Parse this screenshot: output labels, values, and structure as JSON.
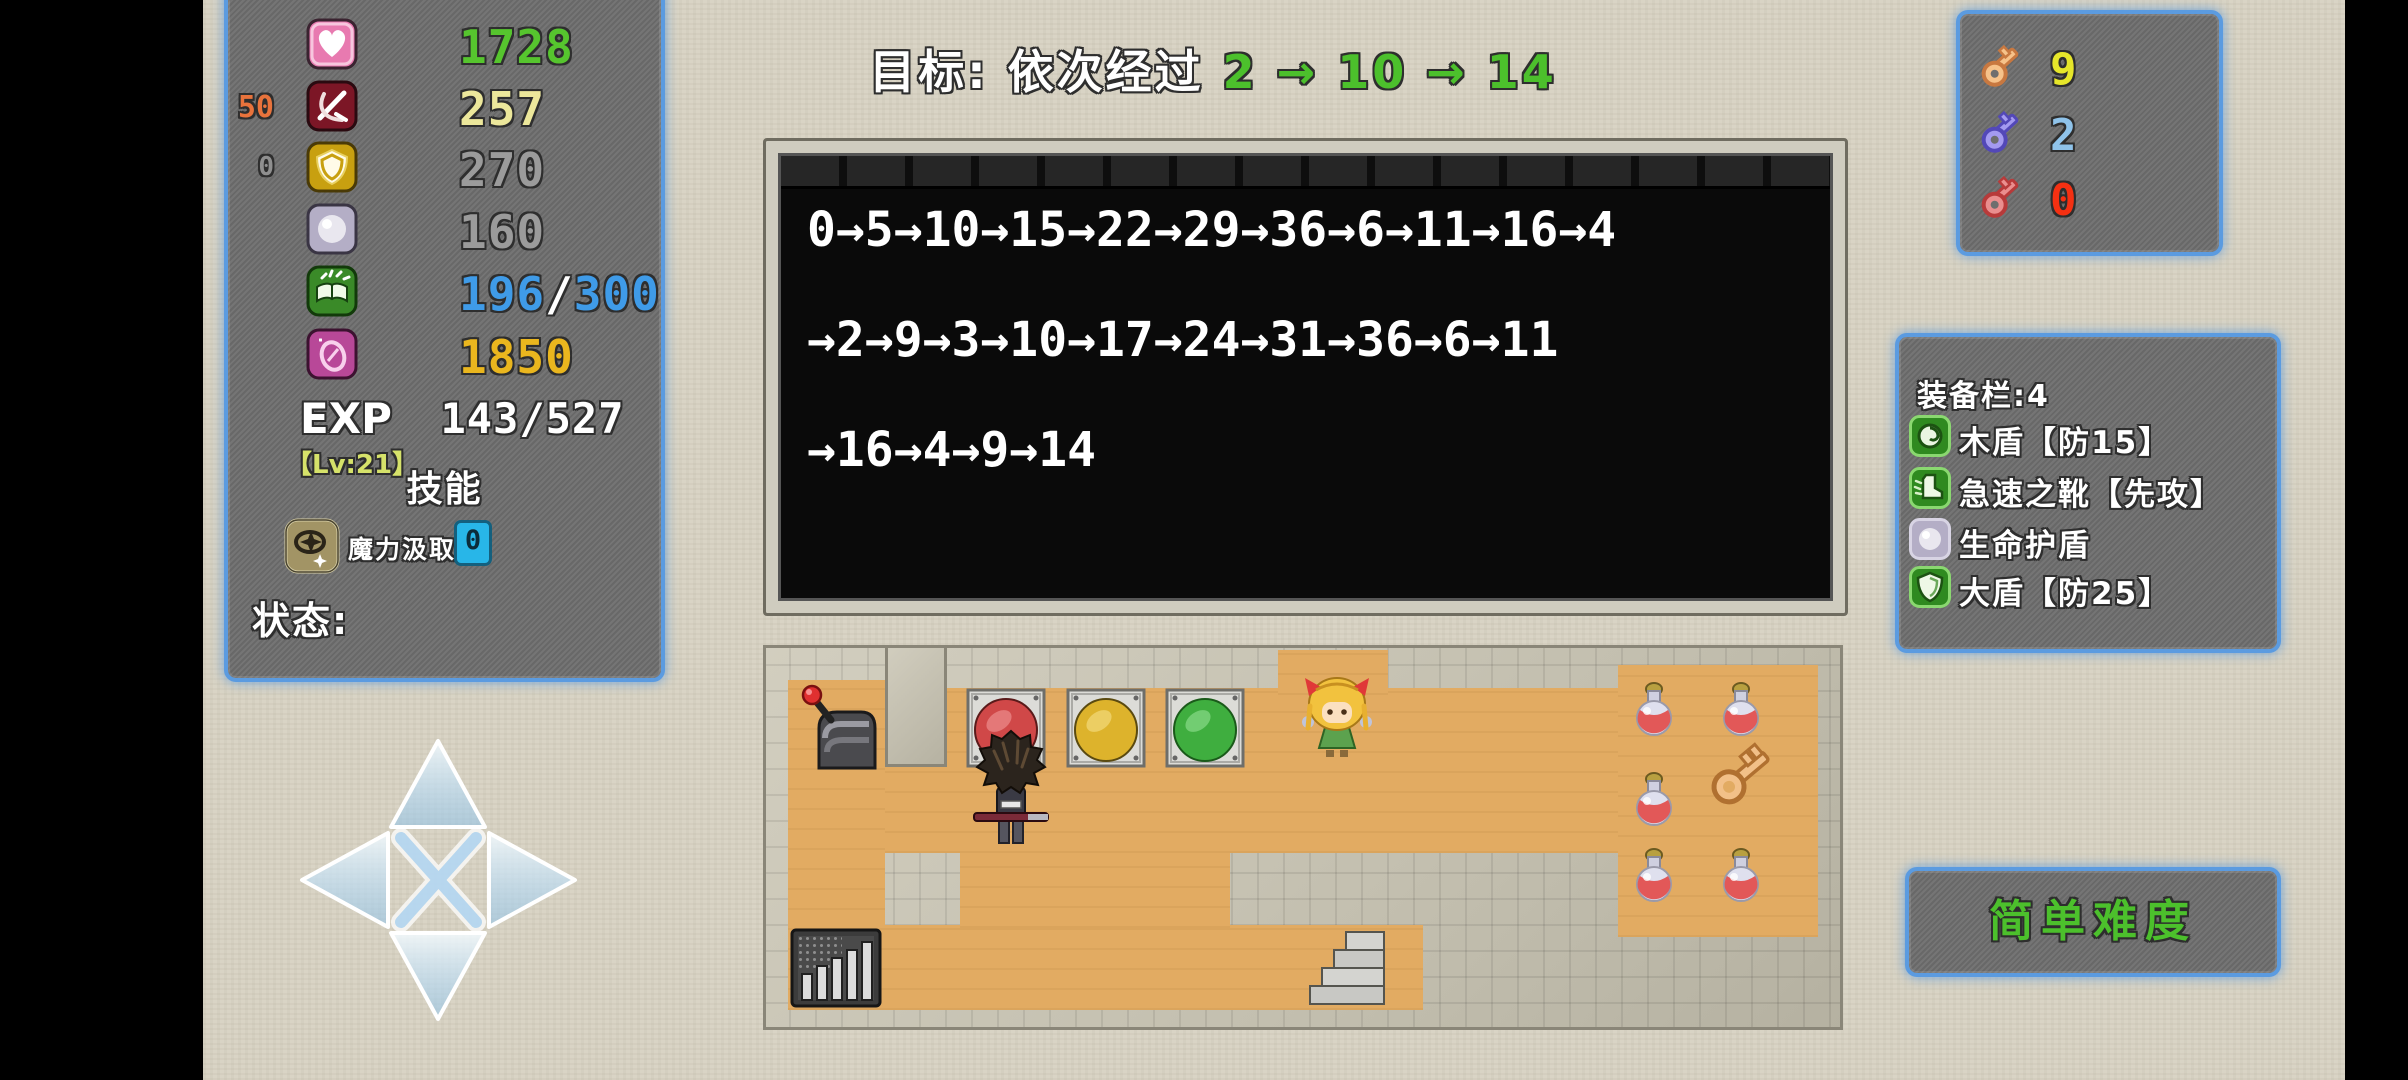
{
  "stats": {
    "rows": [
      {
        "label": "hp",
        "value": "1728",
        "color": "#56c52e"
      },
      {
        "label": "atk",
        "value": "257",
        "color": "#ece79b",
        "badge": "50",
        "badge_color": "#e8733c"
      },
      {
        "label": "def",
        "value": "270",
        "color": "#9b9b9b",
        "badge": "0",
        "badge_color": "#8f8f8f"
      },
      {
        "label": "mdef",
        "value": "160",
        "color": "#9b9b9b"
      },
      {
        "label": "book",
        "current": "196",
        "slash": "/",
        "max": "300",
        "color": "#3f9be8"
      },
      {
        "label": "gold",
        "value": "1850",
        "color": "#eab61e"
      }
    ],
    "exp_label": "EXP",
    "exp_value": "143/527",
    "level": "【Lv:21】",
    "level_color": "#d6e26a",
    "skill_heading": "技能",
    "skill_name": "魔力汲取",
    "skill_value": "0",
    "status_label": "状态:"
  },
  "goal": {
    "prefix": "目标: 依次经过 ",
    "sequence": "2 → 10 → 14",
    "sequence_color": "#4cc02c"
  },
  "console": {
    "lines": [
      "0→5→10→15→22→29→36→6→11→16→4",
      "→2→9→3→10→17→24→31→36→6→11",
      "→16→4→9→14"
    ]
  },
  "keys": [
    {
      "name": "yellow-key",
      "count": "9",
      "count_color": "#e6e62a",
      "key_color": "#f6c28a",
      "key_stroke": "#c87840"
    },
    {
      "name": "blue-key",
      "count": "2",
      "count_color": "#8fc3ea",
      "key_color": "#a49af0",
      "key_stroke": "#5348b8"
    },
    {
      "name": "red-key",
      "count": "0",
      "count_color": "#f53012",
      "key_color": "#ea8e8e",
      "key_stroke": "#b83a3a"
    }
  ],
  "equipment": {
    "title": "装备栏:4",
    "items": [
      {
        "icon": "wood-shield-icon",
        "label": "木盾【防15】"
      },
      {
        "icon": "speed-boots-icon",
        "label": "急速之靴【先攻】"
      },
      {
        "icon": "life-shield-icon",
        "label": "生命护盾"
      },
      {
        "icon": "big-shield-icon",
        "label": "大盾【防25】"
      }
    ]
  },
  "difficulty": {
    "label": "简单难度",
    "color": "#4cc02c"
  },
  "map": {
    "buttons": [
      {
        "name": "red-button",
        "color": "#d04848",
        "light": "#f4a0a0"
      },
      {
        "name": "yellow-button",
        "color": "#ddb32c",
        "light": "#f8e492"
      },
      {
        "name": "green-button",
        "color": "#3fae3f",
        "light": "#9ce89c"
      }
    ]
  }
}
